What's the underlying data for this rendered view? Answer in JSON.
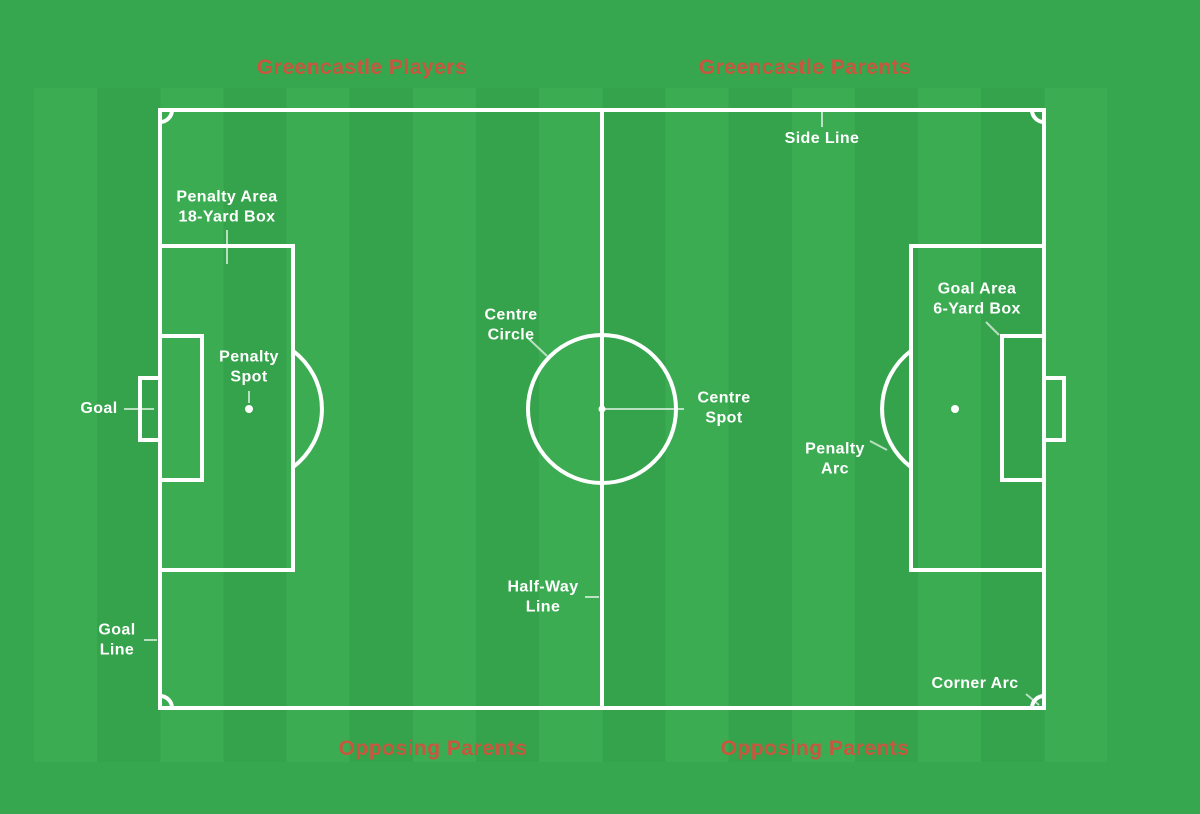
{
  "diagram_title": "Soccer pitch diagram with sideline zone assignments",
  "palette": {
    "field_green": "#36a74e",
    "stripe_light": "#3cac53",
    "stripe_dark": "#34a34b",
    "pitch_line_white": "#ffffff",
    "zone_label_red": "#c9563f"
  },
  "zones": {
    "top_left": "Greencastle Players",
    "top_right": "Greencastle Parents",
    "bottom_left": "Opposing Parents",
    "bottom_right": "Opposing Parents"
  },
  "pitch_labels": {
    "side_line": "Side Line",
    "penalty_area": "Penalty Area\n18-Yard Box",
    "centre_circle": "Centre\nCircle",
    "centre_spot": "Centre\nSpot",
    "penalty_spot": "Penalty\nSpot",
    "goal": "Goal",
    "goal_area": "Goal Area\n6-Yard Box",
    "penalty_arc": "Penalty\nArc",
    "half_way_line": "Half-Way\nLine",
    "goal_line": "Goal\nLine",
    "corner_arc": "Corner Arc"
  }
}
